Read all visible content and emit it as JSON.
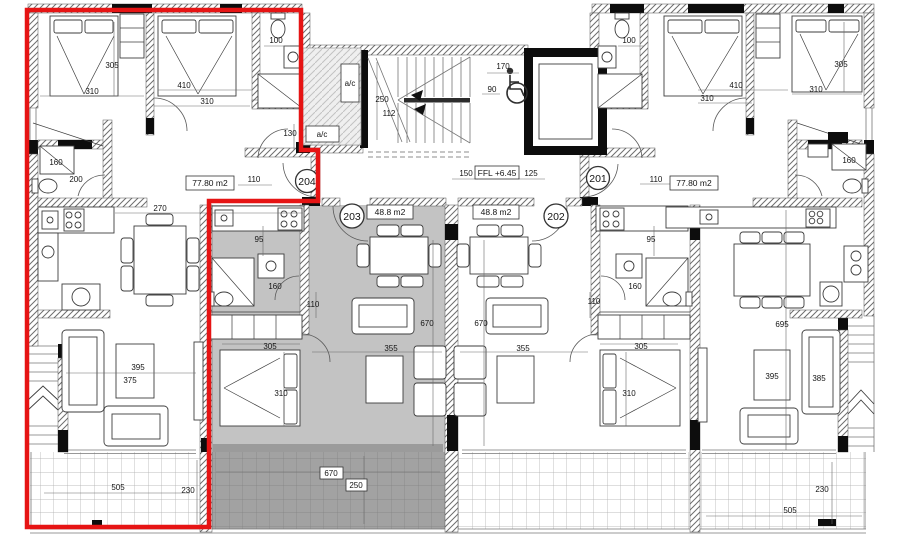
{
  "plan": {
    "kind": "residential floor plan",
    "level_label": "FFL +6.45",
    "highlight_color": "#e61414",
    "highlighted_unit": "204",
    "shaded_unit": "203"
  },
  "units": {
    "u204": {
      "number": "204",
      "area": "77.80 m2"
    },
    "u203": {
      "number": "203",
      "area": "48.8 m2"
    },
    "u202": {
      "number": "202",
      "area": "48.8 m2"
    },
    "u201": {
      "number": "201",
      "area": "77.80 m2"
    }
  },
  "core": {
    "ac1": "a/c",
    "ac2": "a/c",
    "ffl": "FFL +6.45",
    "stair_run": "250",
    "stair_width": "112",
    "lift_clear_w": "170",
    "lift_clear_d": "90",
    "lobby_w1": "150",
    "lobby_w2": "125"
  },
  "d204": {
    "wc": "100",
    "bed1_len": "305",
    "bed1_wid": "310",
    "bed2_len": "410",
    "bed2_wid": "310",
    "niche": "130",
    "shower": "160",
    "bath": "200",
    "hall": "110",
    "kitchen": "270",
    "living_len": "395",
    "living_wid": "375",
    "balcony_len": "505",
    "balcony_dep": "230"
  },
  "d203": {
    "kitchen": "95",
    "shower": "160",
    "hall": "110",
    "bed_wid": "305",
    "bed_len": "310",
    "living_len": "670",
    "living_wid": "355",
    "balcony_len": "670",
    "balcony_dep": "250"
  },
  "d202": {
    "hall": "110",
    "kitchen": "95",
    "shower": "160",
    "bed_wid": "305",
    "bed_len": "310",
    "living_len": "670",
    "living_wid": "355"
  },
  "d201": {
    "wc": "100",
    "bed1_len": "410",
    "bed1_wid": "310",
    "bed2_len": "305",
    "bed2_wid": "310",
    "hall": "110",
    "shower": "160",
    "living_len": "695",
    "table": "395",
    "sofa": "385",
    "balcony_len": "505",
    "balcony_dep": "230"
  }
}
